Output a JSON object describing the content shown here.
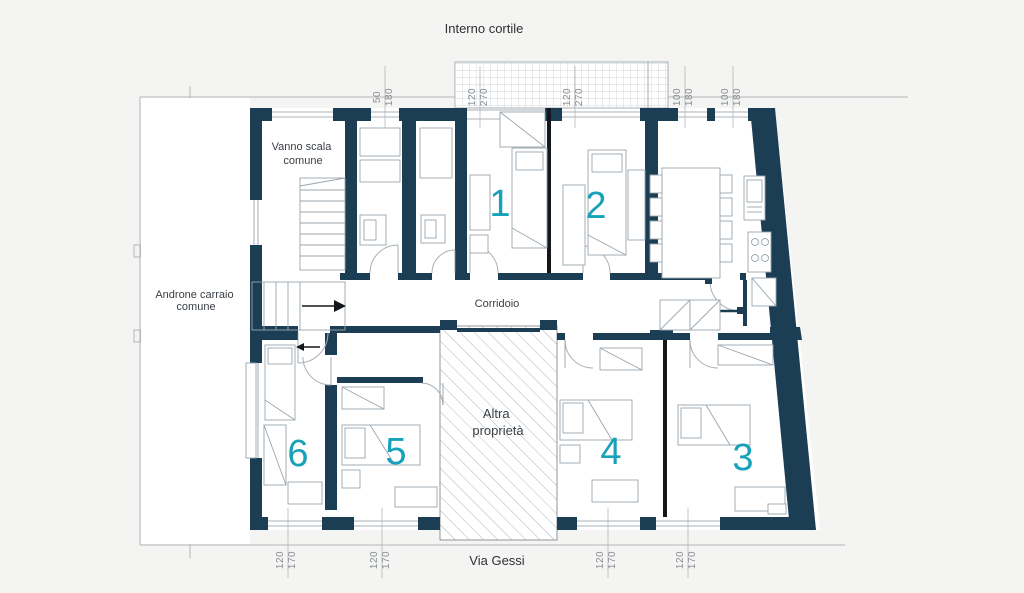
{
  "labels": {
    "top": "Interno cortile",
    "bottom": "Via Gessi",
    "stairwell": [
      "Vanno scala",
      "comune"
    ],
    "androne": [
      "Androne carraio",
      "comune"
    ],
    "corridor": "Corridoio",
    "altra": [
      "Altra",
      "proprietà"
    ]
  },
  "room_numbers": [
    "1",
    "2",
    "3",
    "4",
    "5",
    "6"
  ],
  "dims_top": [
    {
      "a": "50",
      "b": "180"
    },
    {
      "a": "120",
      "b": "270"
    },
    {
      "a": "120",
      "b": "270"
    },
    {
      "a": "100",
      "b": "180"
    },
    {
      "a": "100",
      "b": "180"
    }
  ],
  "dims_bottom": [
    {
      "a": "120",
      "b": "170"
    },
    {
      "a": "120",
      "b": "170"
    },
    {
      "a": "120",
      "b": "170"
    },
    {
      "a": "120",
      "b": "170"
    }
  ],
  "colors": {
    "wall": "#1c3e55",
    "accent": "#18a2ba",
    "hatch_line": "#9aa1a8",
    "background": "#f4f4f2"
  }
}
